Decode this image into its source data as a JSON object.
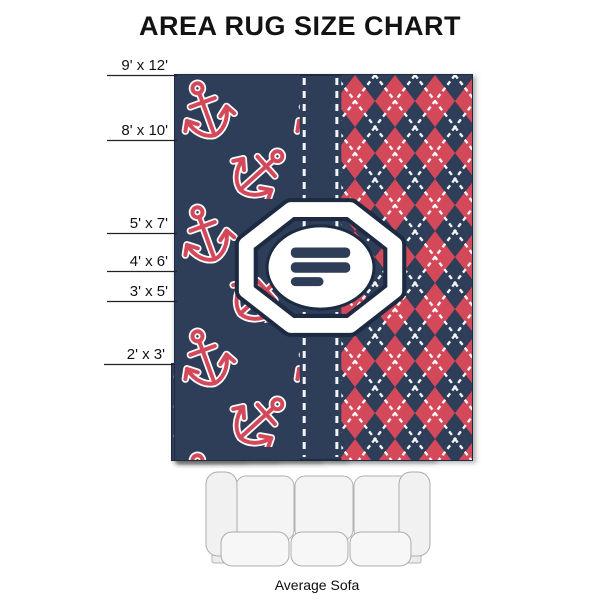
{
  "title": "AREA RUG SIZE CHART",
  "caption": "Average Sofa",
  "colors": {
    "navy": "#2e3d59",
    "navy_dark": "#1e2a42",
    "red": "#d4495a",
    "white": "#ffffff",
    "text": "#111111",
    "label_line": "#222222",
    "sofa_fill": "#f4f4f4",
    "sofa_fill_light": "#f7f7f7",
    "sofa_stroke": "#b2b2b2",
    "shadow": "#666666"
  },
  "rugs": [
    {
      "label": "9' x 12'",
      "x": 175,
      "y": 75,
      "w": 297,
      "h": 385
    },
    {
      "label": "8' x 10'",
      "x": 175,
      "y": 140,
      "w": 258,
      "h": 320
    },
    {
      "label": "5' x 7'",
      "x": 175,
      "y": 233,
      "w": 170,
      "h": 227
    },
    {
      "label": "4' x 6'",
      "x": 175,
      "y": 271,
      "w": 143,
      "h": 189
    },
    {
      "label": "3' x 5'",
      "x": 175,
      "y": 301,
      "w": 100,
      "h": 159
    },
    {
      "label": "2' x 3'",
      "x": 172,
      "y": 364,
      "w": 71,
      "h": 96
    }
  ]
}
